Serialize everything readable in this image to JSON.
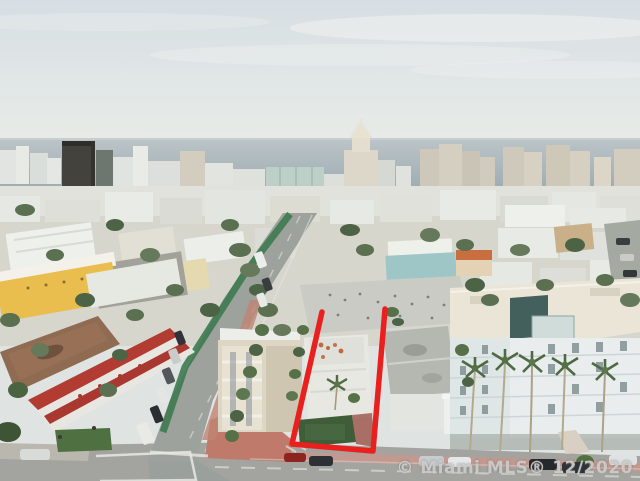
{
  "meta": {
    "description": "Aerial drone photograph of a Miami Beach neighborhood looking toward the ocean, with a red outline highlighting a property lot for sale",
    "type": "aerial-real-estate-photo"
  },
  "watermark": {
    "text": "© Miami MLS® 12/2020"
  },
  "scene": {
    "highlight": {
      "name": "property-boundary",
      "color": "#e9201d",
      "shape": "open-top quadrilateral (perspective lot lines)",
      "corners": [
        [
          322,
          312
        ],
        [
          292,
          444
        ],
        [
          373,
          451
        ],
        [
          385,
          309
        ]
      ]
    },
    "colors": {
      "sky_top": "#d7dee3",
      "sky_horizon": "#eaece7",
      "ocean": "#a8b5ba",
      "dark_tower": "#43423c",
      "vegetation": "#567148",
      "road_asphalt": "#a3a49f",
      "bike_lane_green": "#3e7a50",
      "brick_sidewalk": "#c08573",
      "yellow_building": "#e9bd4e",
      "red_motel_trim": "#b23b32",
      "condo_roof": "#eae5d6",
      "condo_facade": "#e9eded",
      "watermark_gray": "#d0d0ce"
    },
    "landmarks": [
      "ocean-horizon",
      "city-skyline",
      "spired-hotel-tower",
      "dark-office-tower",
      "diagonal-avenue-with-green-bike-lane",
      "cross-street-intersection",
      "outlined-property-lot",
      "gray-roof-house",
      "large-white-condo",
      "yellow-building",
      "red-trim-motel",
      "palm-trees",
      "parked-cars"
    ]
  }
}
